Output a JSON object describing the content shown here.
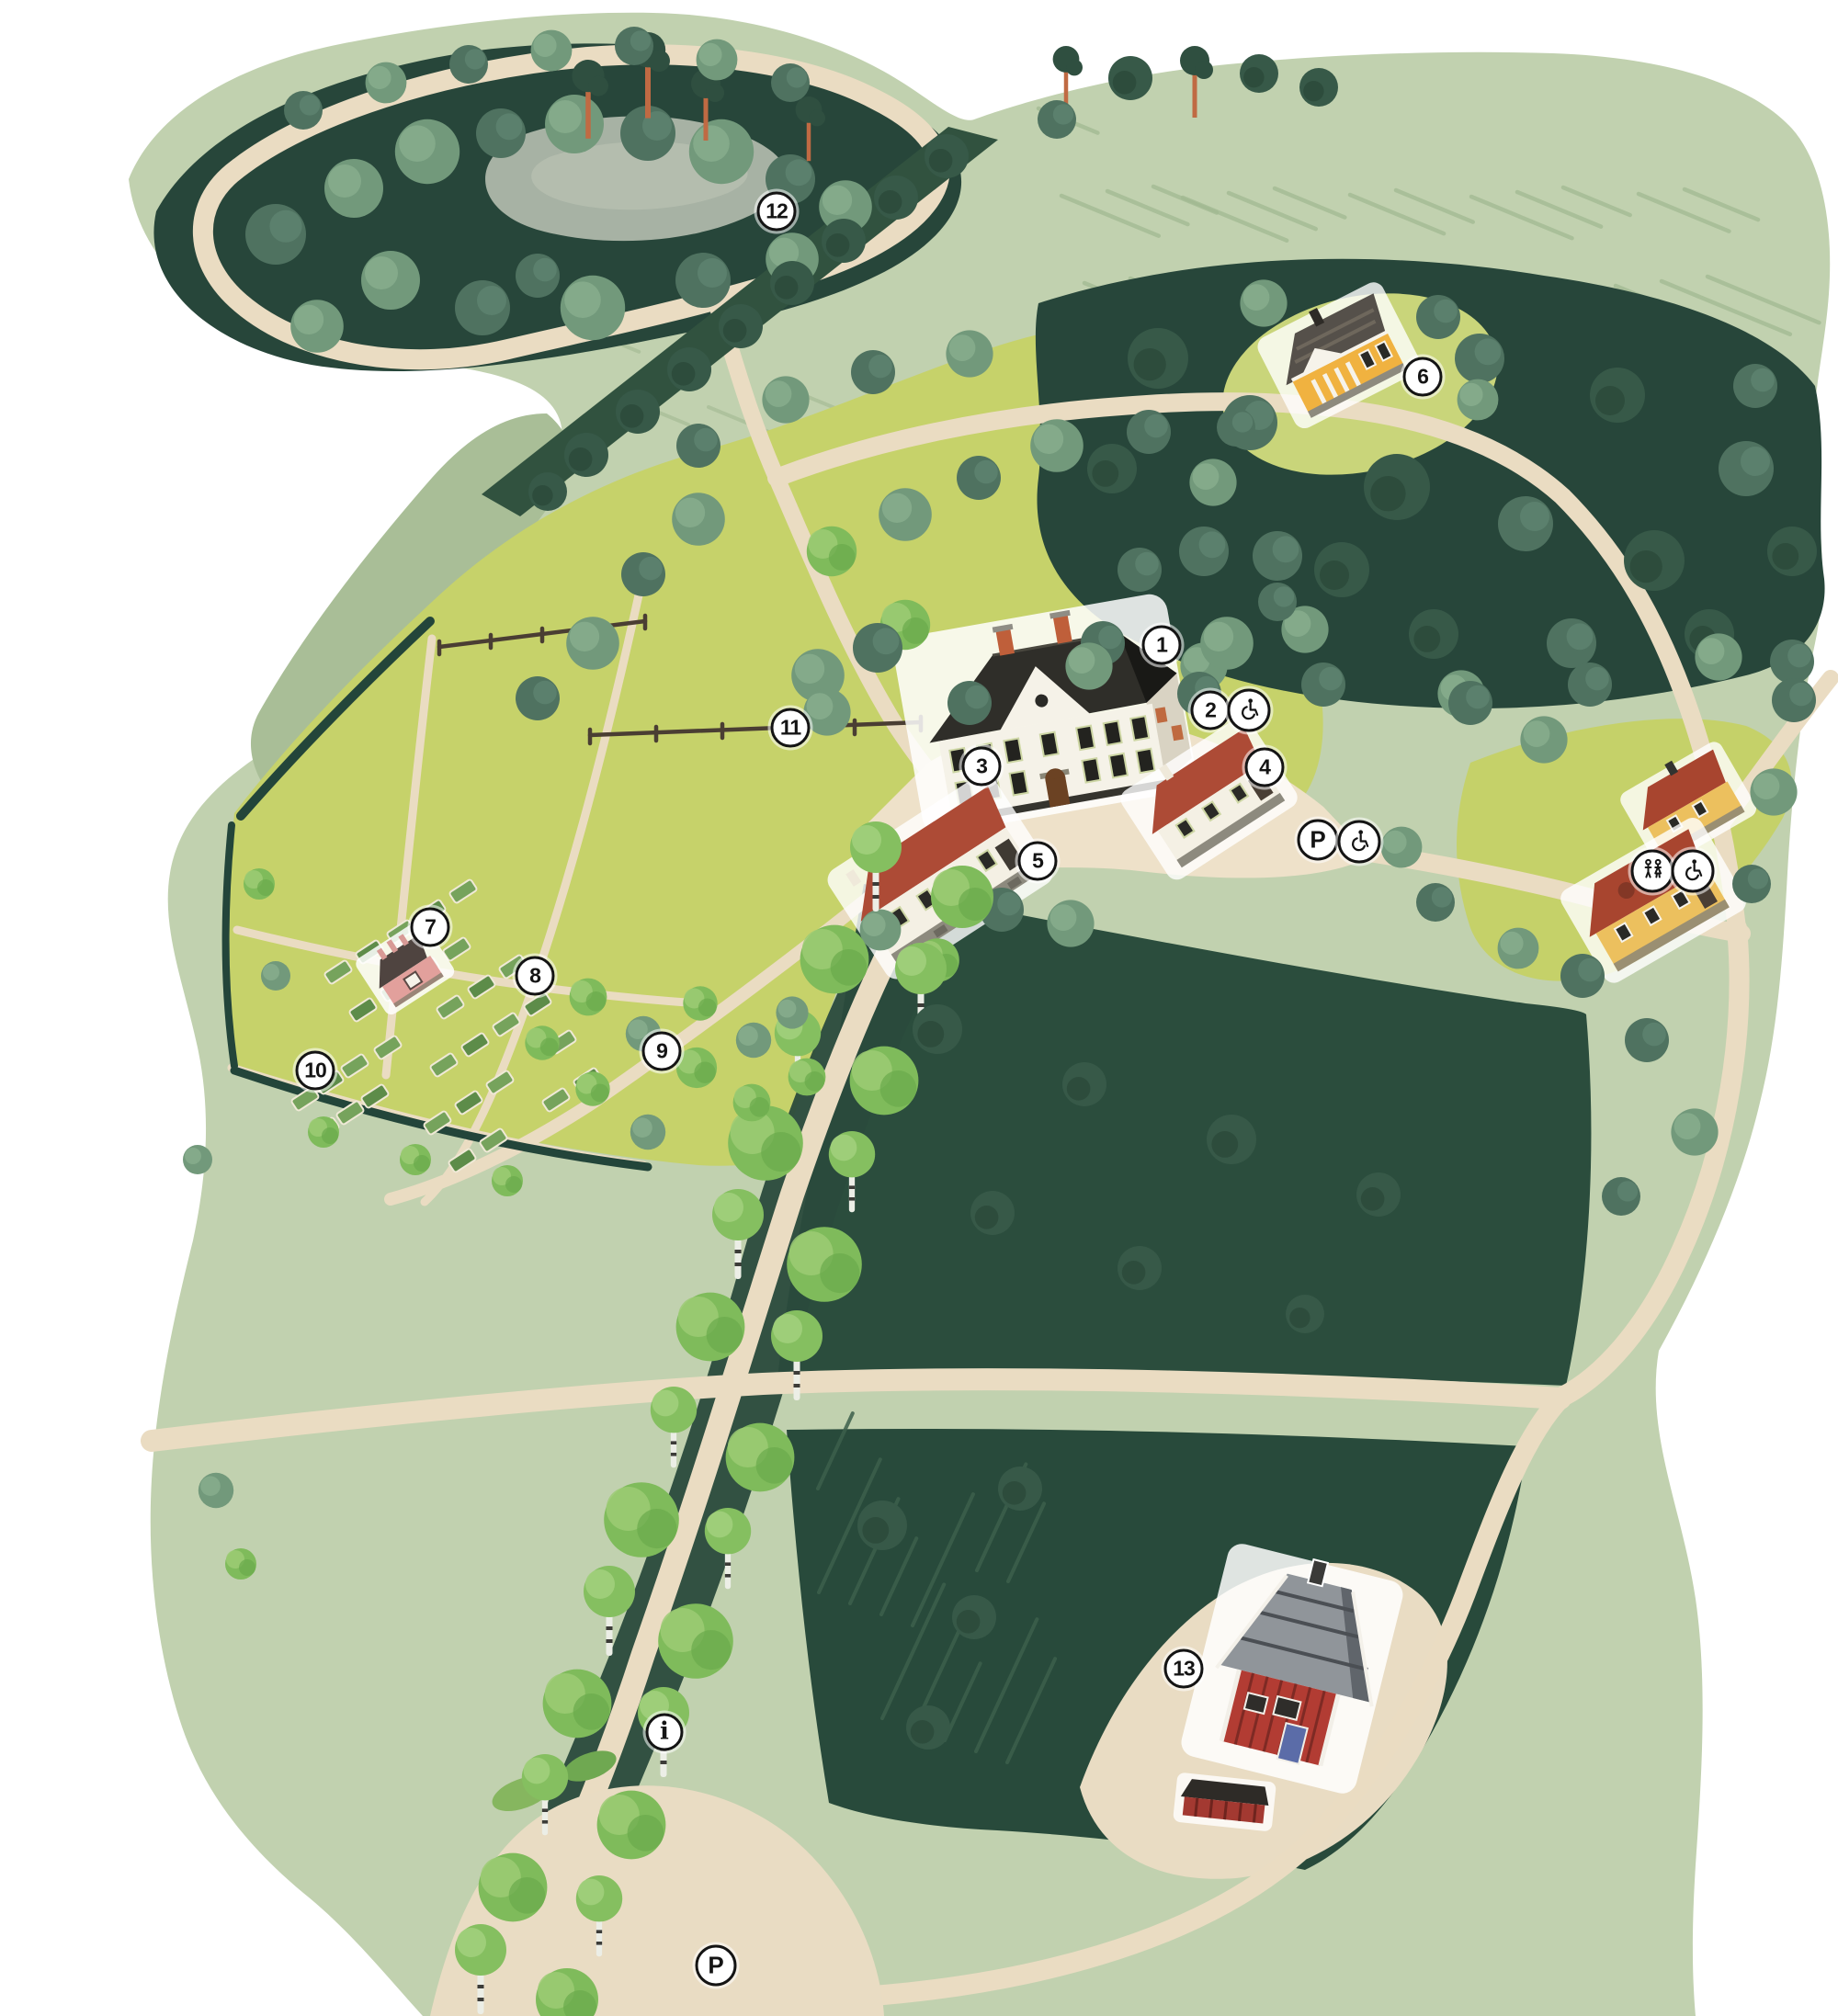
{
  "map": {
    "type": "illustrated-estate-map",
    "colors": {
      "background": "#ffffff",
      "parkland": "#c1d1af",
      "meadow": "#a9be97",
      "lawn": "#c6d26a",
      "forest_dark": "#27463a",
      "field_dark": "#2b4d3d",
      "path": "#eadcc2",
      "pond": "#a7b2a4",
      "marker_bg": "#ffffff",
      "marker_border": "#141414"
    },
    "markers": [
      {
        "id": "marker-1",
        "kind": "number",
        "label": "1",
        "x_pct": 63.2,
        "y_pct": 32.0
      },
      {
        "id": "marker-2",
        "kind": "number",
        "label": "2",
        "x_pct": 65.85,
        "y_pct": 35.23
      },
      {
        "id": "marker-3",
        "kind": "number",
        "label": "3",
        "x_pct": 53.4,
        "y_pct": 38.0
      },
      {
        "id": "marker-4",
        "kind": "number",
        "label": "4",
        "x_pct": 68.8,
        "y_pct": 38.05
      },
      {
        "id": "marker-5",
        "kind": "number",
        "label": "5",
        "x_pct": 56.45,
        "y_pct": 42.7
      },
      {
        "id": "marker-6",
        "kind": "number",
        "label": "6",
        "x_pct": 77.4,
        "y_pct": 18.7
      },
      {
        "id": "marker-7",
        "kind": "number",
        "label": "7",
        "x_pct": 23.4,
        "y_pct": 46.0
      },
      {
        "id": "marker-8",
        "kind": "number",
        "label": "8",
        "x_pct": 29.1,
        "y_pct": 48.4
      },
      {
        "id": "marker-9",
        "kind": "number",
        "label": "9",
        "x_pct": 36.0,
        "y_pct": 52.15
      },
      {
        "id": "marker-10",
        "kind": "number",
        "label": "10",
        "x_pct": 17.15,
        "y_pct": 53.1
      },
      {
        "id": "marker-11",
        "kind": "number",
        "label": "11",
        "x_pct": 43.0,
        "y_pct": 36.1
      },
      {
        "id": "marker-12",
        "kind": "number",
        "label": "12",
        "x_pct": 42.25,
        "y_pct": 10.5
      },
      {
        "id": "marker-13",
        "kind": "number",
        "label": "13",
        "x_pct": 64.4,
        "y_pct": 82.75
      },
      {
        "id": "marker-accessible-entrance",
        "kind": "accessible",
        "icon": "wheelchair-icon",
        "x_pct": 67.95,
        "y_pct": 35.23
      },
      {
        "id": "marker-parking-main",
        "kind": "parking",
        "label": "P",
        "x_pct": 71.7,
        "y_pct": 41.65
      },
      {
        "id": "marker-accessible-parking",
        "kind": "accessible",
        "icon": "wheelchair-icon",
        "x_pct": 73.95,
        "y_pct": 41.75
      },
      {
        "id": "marker-toilets",
        "kind": "toilets",
        "icon": "wc-icon",
        "x_pct": 89.9,
        "y_pct": 43.2
      },
      {
        "id": "marker-accessible-toilets",
        "kind": "accessible",
        "icon": "wheelchair-icon",
        "x_pct": 92.1,
        "y_pct": 43.2
      },
      {
        "id": "marker-info",
        "kind": "info",
        "label": "i",
        "x_pct": 36.15,
        "y_pct": 85.9
      },
      {
        "id": "marker-parking-south",
        "kind": "parking",
        "label": "P",
        "x_pct": 38.95,
        "y_pct": 97.5
      }
    ]
  }
}
